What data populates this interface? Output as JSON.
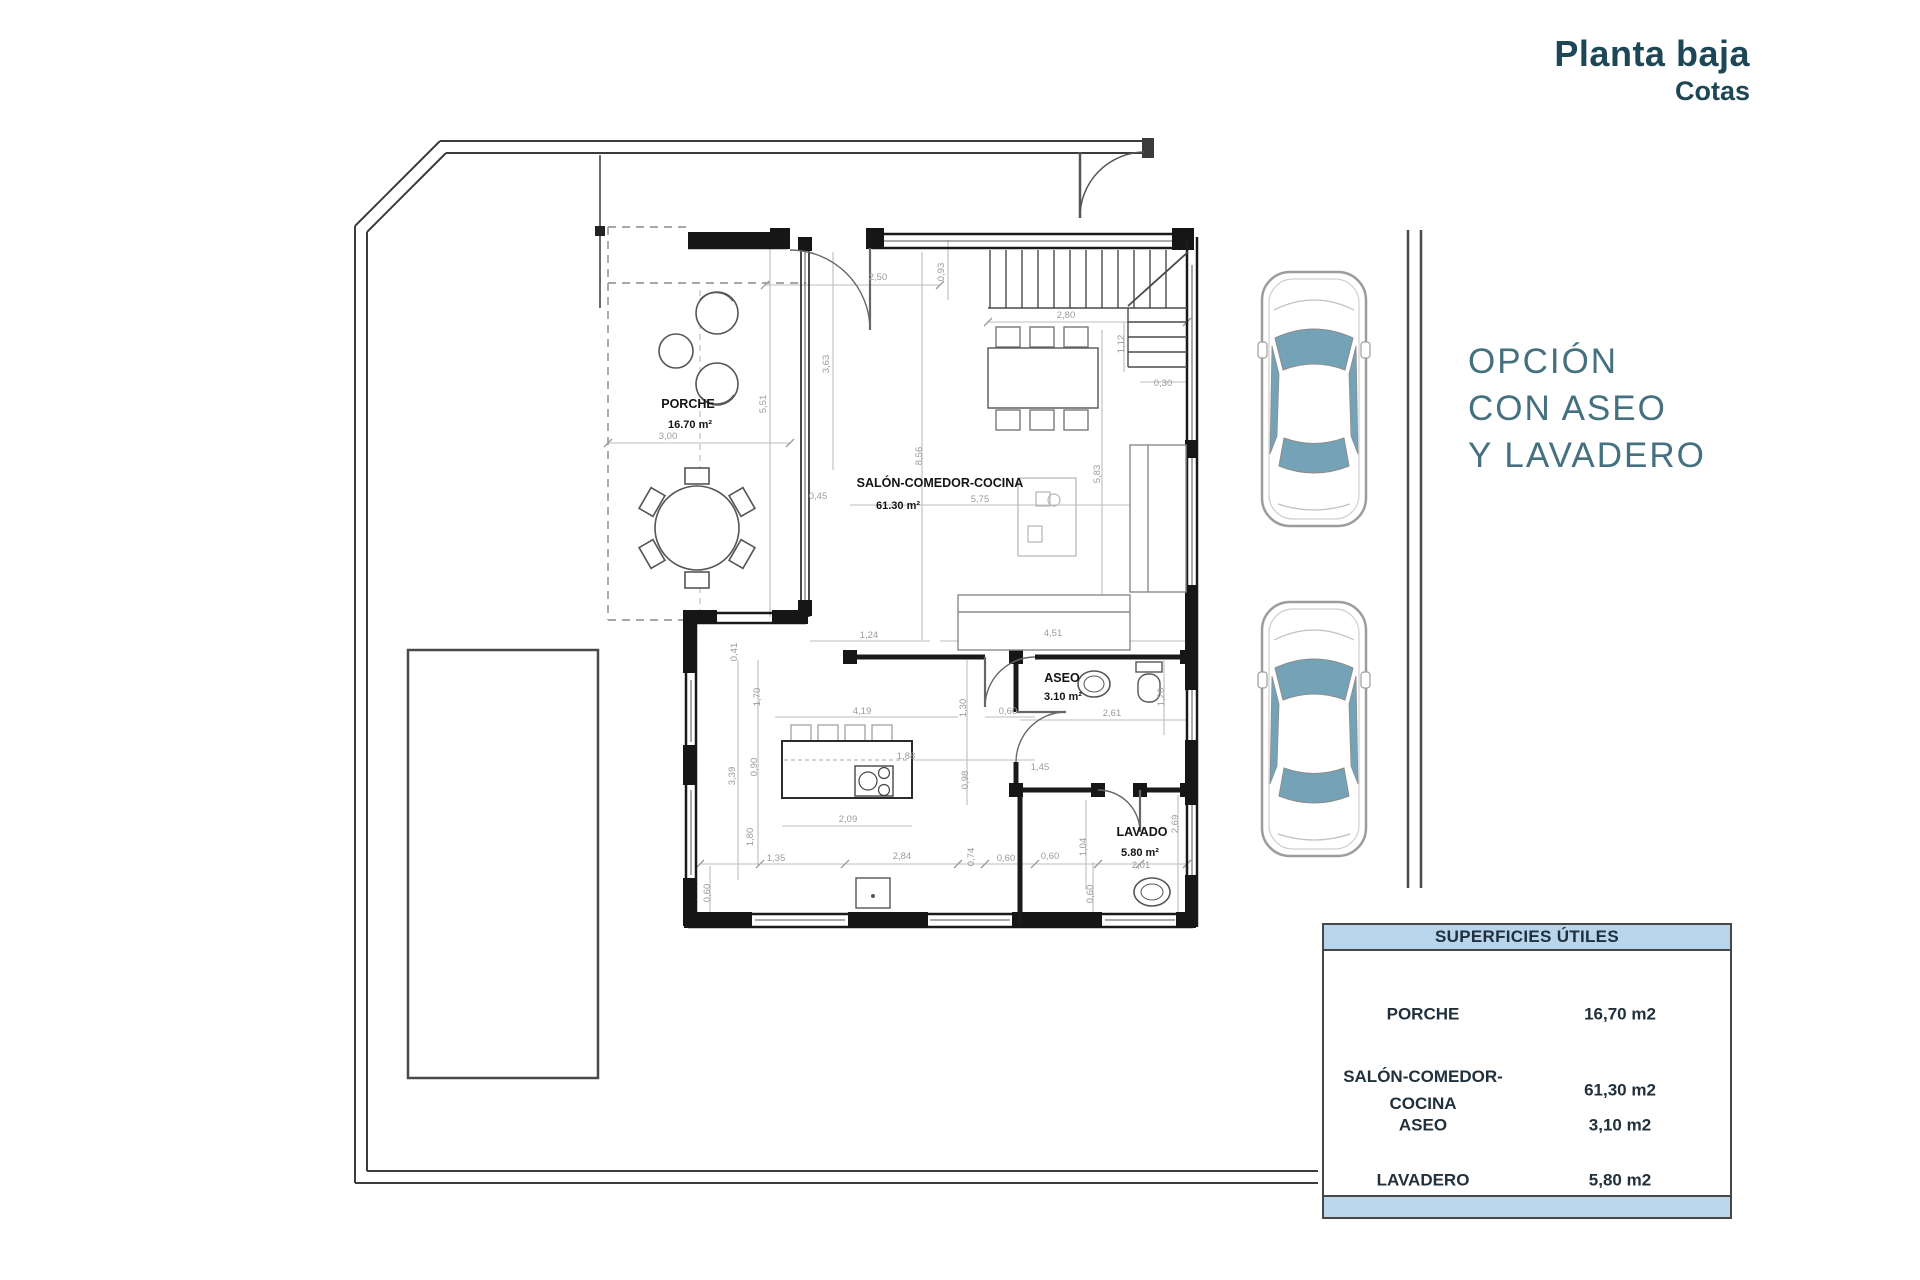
{
  "header": {
    "title": "Planta baja",
    "subtitle": "Cotas"
  },
  "side_note": {
    "lines": [
      "OPCIÓN",
      "CON ASEO",
      "Y LAVADERO"
    ]
  },
  "summary_table": {
    "title": "SUPERFICIES ÚTILES",
    "rows": [
      {
        "label_lines": [
          "PORCHE"
        ],
        "value": "16,70 m2"
      },
      {
        "label_lines": [
          "SALÓN-COMEDOR-",
          "COCINA"
        ],
        "value": "61,30 m2"
      },
      {
        "label_lines": [
          "ASEO"
        ],
        "value": "3,10 m2"
      },
      {
        "label_lines": [
          "LAVADERO"
        ],
        "value": "5,80 m2"
      }
    ]
  },
  "colors": {
    "accent_title": "#1d4756",
    "side_note": "#44707f",
    "table_header_bg": "#b9d5ec",
    "car_glass": "#74a3b8"
  },
  "plan": {
    "rooms": [
      {
        "name": "PORCHE",
        "area": "16.70 m²",
        "nx": 688,
        "ny": 408,
        "ax": 690,
        "ay": 428
      },
      {
        "name": "SALÓN-COMEDOR-COCINA",
        "area": "61.30 m²",
        "nx": 940,
        "ny": 487,
        "ax": 898,
        "ay": 509
      },
      {
        "name": "ASEO",
        "area": "3.10 m²",
        "nx": 1062,
        "ny": 682,
        "ax": 1063,
        "ay": 700
      },
      {
        "name": "LAVADO",
        "area": "5.80 m²",
        "nx": 1142,
        "ny": 836,
        "ax": 1140,
        "ay": 856
      }
    ],
    "dims": [
      {
        "t": "2,50",
        "x": 878,
        "y": 280,
        "r": 0
      },
      {
        "t": "0,93",
        "x": 944,
        "y": 272,
        "r": -90
      },
      {
        "t": "2,80",
        "x": 1066,
        "y": 318,
        "r": 0
      },
      {
        "t": "1,12",
        "x": 1124,
        "y": 344,
        "r": -90
      },
      {
        "t": "0,30",
        "x": 1163,
        "y": 386,
        "r": 0
      },
      {
        "t": "3,63",
        "x": 829,
        "y": 364,
        "r": -90
      },
      {
        "t": "5,51",
        "x": 766,
        "y": 404,
        "r": -90
      },
      {
        "t": "3,00",
        "x": 668,
        "y": 439,
        "r": 0
      },
      {
        "t": "0,45",
        "x": 818,
        "y": 499,
        "r": 0
      },
      {
        "t": "8,56",
        "x": 922,
        "y": 456,
        "r": -90
      },
      {
        "t": "5,75",
        "x": 980,
        "y": 502,
        "r": 0
      },
      {
        "t": "5,83",
        "x": 1100,
        "y": 474,
        "r": -90
      },
      {
        "t": "1,24",
        "x": 869,
        "y": 638,
        "r": 0
      },
      {
        "t": "4,51",
        "x": 1053,
        "y": 636,
        "r": 0
      },
      {
        "t": "0,41",
        "x": 737,
        "y": 652,
        "r": -90
      },
      {
        "t": "1,70",
        "x": 760,
        "y": 697,
        "r": -90
      },
      {
        "t": "0,90",
        "x": 757,
        "y": 767,
        "r": -90
      },
      {
        "t": "3,39",
        "x": 735,
        "y": 776,
        "r": -90
      },
      {
        "t": "1,80",
        "x": 753,
        "y": 837,
        "r": -90
      },
      {
        "t": "4,19",
        "x": 862,
        "y": 714,
        "r": 0
      },
      {
        "t": "0,60",
        "x": 1008,
        "y": 714,
        "r": 0
      },
      {
        "t": "1,30",
        "x": 966,
        "y": 708,
        "r": -90
      },
      {
        "t": "0,98",
        "x": 968,
        "y": 780,
        "r": -90
      },
      {
        "t": "2,09",
        "x": 848,
        "y": 822,
        "r": 0
      },
      {
        "t": "1,88",
        "x": 906,
        "y": 759,
        "r": 0
      },
      {
        "t": "1,45",
        "x": 1040,
        "y": 770,
        "r": 0
      },
      {
        "t": "2,61",
        "x": 1112,
        "y": 716,
        "r": 0
      },
      {
        "t": "1,20",
        "x": 1164,
        "y": 697,
        "r": -90
      },
      {
        "t": "1,35",
        "x": 776,
        "y": 861,
        "r": 0
      },
      {
        "t": "2,84",
        "x": 902,
        "y": 859,
        "r": 0
      },
      {
        "t": "0,74",
        "x": 974,
        "y": 857,
        "r": -90
      },
      {
        "t": "0,60",
        "x": 1006,
        "y": 861,
        "r": 0
      },
      {
        "t": "0,60",
        "x": 1050,
        "y": 859,
        "r": 0
      },
      {
        "t": "1,04",
        "x": 1086,
        "y": 847,
        "r": -90
      },
      {
        "t": "0,60",
        "x": 1093,
        "y": 894,
        "r": -90
      },
      {
        "t": "2,01",
        "x": 1141,
        "y": 868,
        "r": 0
      },
      {
        "t": "2,69",
        "x": 1178,
        "y": 824,
        "r": -90
      },
      {
        "t": "0,60",
        "x": 710,
        "y": 893,
        "r": -90
      }
    ]
  }
}
